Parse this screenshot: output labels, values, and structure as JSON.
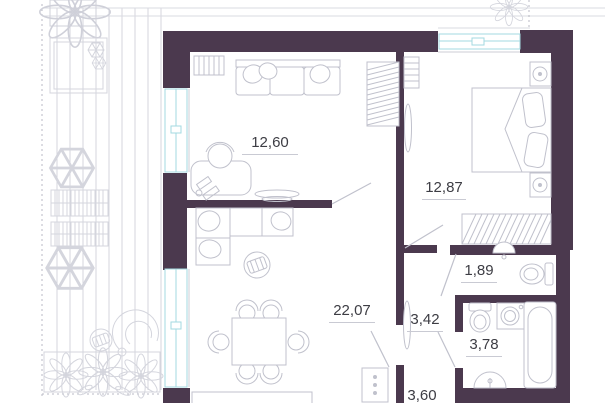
{
  "plan": {
    "type": "apartment-floor-plan",
    "rooms": [
      {
        "key": "room-a",
        "area": "12,60"
      },
      {
        "key": "bedroom",
        "area": "12,87"
      },
      {
        "key": "living-room",
        "area": "22,07"
      },
      {
        "key": "hallway",
        "area": "3,42"
      },
      {
        "key": "wc",
        "area": "1,89"
      },
      {
        "key": "bathroom",
        "area": "3,78"
      },
      {
        "key": "entry",
        "area": "3,60"
      }
    ],
    "colors": {
      "wall": "#4b394e",
      "window": "#a3dae0",
      "furniture_line": "#c0c1cc",
      "terrace_line": "#d4d5dd",
      "label_text": "#3d3d44"
    }
  }
}
